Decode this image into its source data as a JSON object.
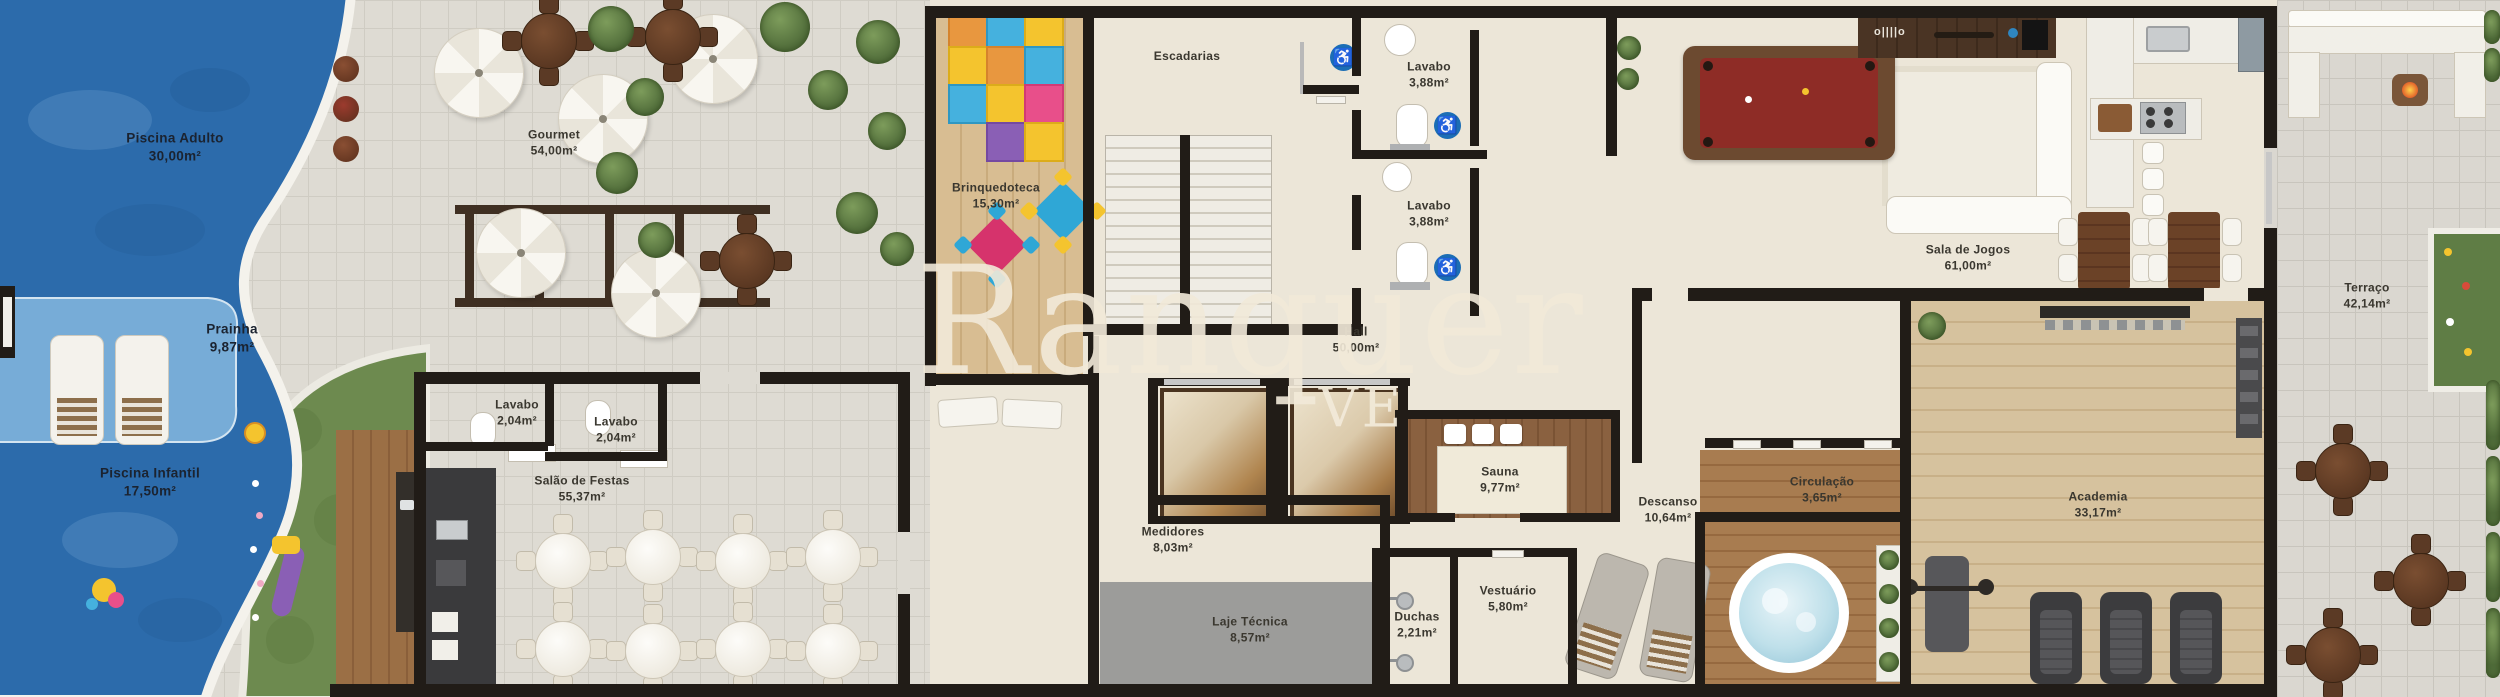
{
  "plan_title": "Pavimento de lazer - planta humanizada",
  "watermark": {
    "text": "Ranquer",
    "fragment": "VE"
  },
  "icons": {
    "accessible": "♿",
    "tv_console": "o||||o"
  },
  "colors": {
    "pool_blue": "#2c6bab",
    "shallow_blue": "#7cb0da",
    "grass_green": "#6d8a4f",
    "wall_black": "#211c17",
    "label_text": "#3a372f",
    "watermark_cream": "#f2ead9",
    "accessible_blue": "#1b6eb5",
    "billiard_red": "#8e2c26",
    "laje_gray": "#9c9c9a"
  },
  "rooms": [
    {
      "id": "piscina-adulto",
      "name": "Piscina Adulto",
      "area": "30,00m²"
    },
    {
      "id": "prainha",
      "name": "Prainha",
      "area": "9,87m²"
    },
    {
      "id": "piscina-infantil",
      "name": "Piscina Infantil",
      "area": "17,50m²"
    },
    {
      "id": "gourmet",
      "name": "Gourmet",
      "area": "54,00m²"
    },
    {
      "id": "brinquedoteca",
      "name": "Brinquedoteca",
      "area": "15,30m²"
    },
    {
      "id": "escadarias",
      "name": "Escadarias",
      "area": ""
    },
    {
      "id": "lavabo-1",
      "name": "Lavabo",
      "area": "3,88m²"
    },
    {
      "id": "lavabo-2",
      "name": "Lavabo",
      "area": "3,88m²"
    },
    {
      "id": "hall",
      "name": "Hall",
      "area": "50,00m²"
    },
    {
      "id": "sala-de-jogos",
      "name": "Sala de Jogos",
      "area": "61,00m²"
    },
    {
      "id": "terraco",
      "name": "Terraço",
      "area": "42,14m²"
    },
    {
      "id": "lavabo-3",
      "name": "Lavabo",
      "area": "2,04m²"
    },
    {
      "id": "lavabo-4",
      "name": "Lavabo",
      "area": "2,04m²"
    },
    {
      "id": "salao-de-festas",
      "name": "Salão de Festas",
      "area": "55,37m²"
    },
    {
      "id": "medidores",
      "name": "Medidores",
      "area": "8,03m²"
    },
    {
      "id": "laje-tecnica",
      "name": "Laje Técnica",
      "area": "8,57m²"
    },
    {
      "id": "sauna",
      "name": "Sauna",
      "area": "9,77m²"
    },
    {
      "id": "duchas",
      "name": "Duchas",
      "area": "2,21m²"
    },
    {
      "id": "vestuario",
      "name": "Vestuário",
      "area": "5,80m²"
    },
    {
      "id": "descanso",
      "name": "Descanso",
      "area": "10,64m²"
    },
    {
      "id": "circulacao",
      "name": "Circulação",
      "area": "3,65m²"
    },
    {
      "id": "academia",
      "name": "Academia",
      "area": "33,17m²"
    }
  ]
}
